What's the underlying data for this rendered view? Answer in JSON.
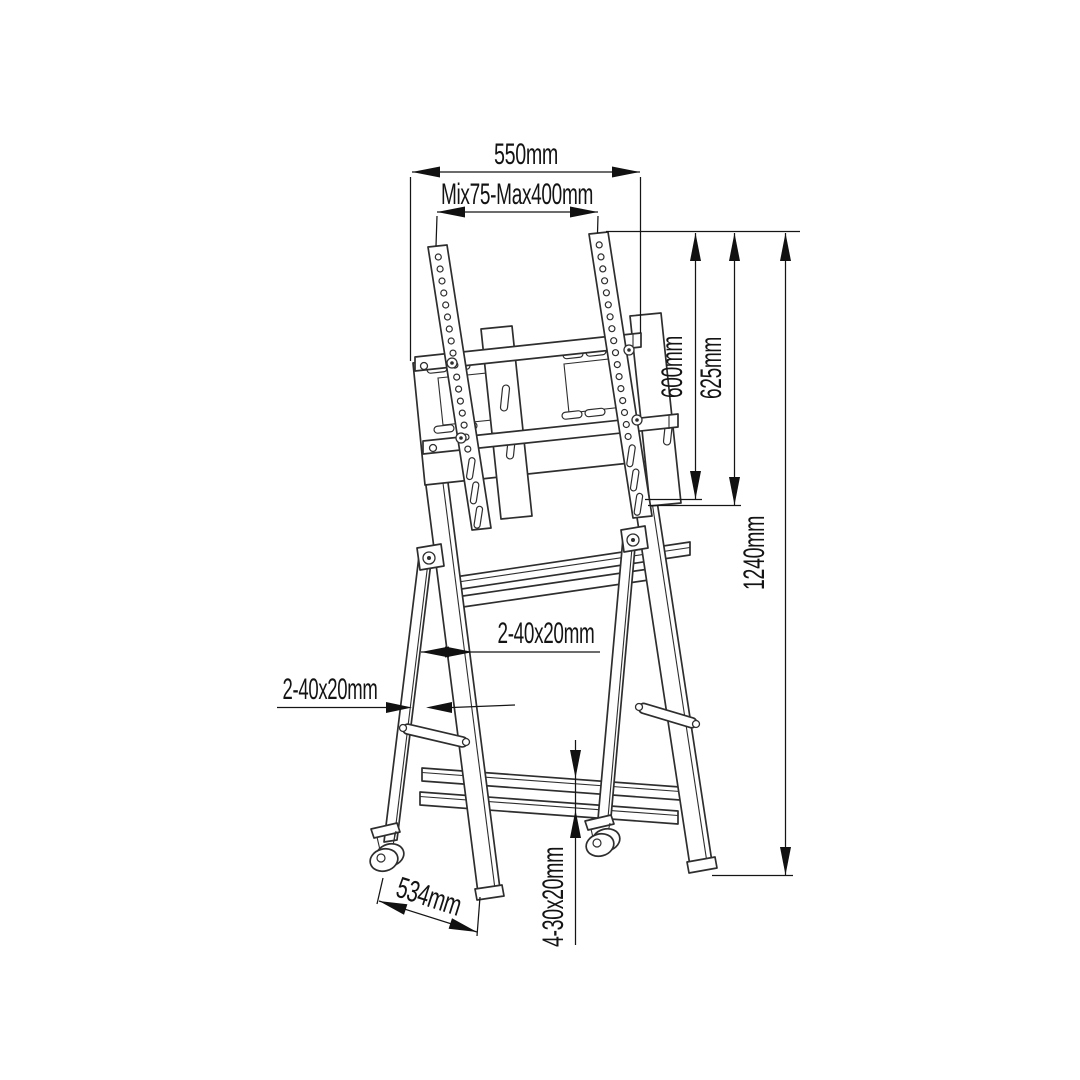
{
  "page": {
    "background": "#ffffff"
  },
  "drawing": {
    "line_color": "#2e2e2e",
    "dimension_color": "#141414",
    "subject": "mobile-tv-floor-stand",
    "dimensions": {
      "top_width": "550mm",
      "vesa_range": "Mix75-Max400mm",
      "bracket_height": "600mm",
      "upright_height": "625mm",
      "total_height": "1240mm",
      "upper_leg_profile": "2-40x20mm",
      "lower_leg_profile": "2-40x20mm",
      "base_depth": "534mm",
      "base_bar_profile": "4-30x20mm"
    }
  }
}
